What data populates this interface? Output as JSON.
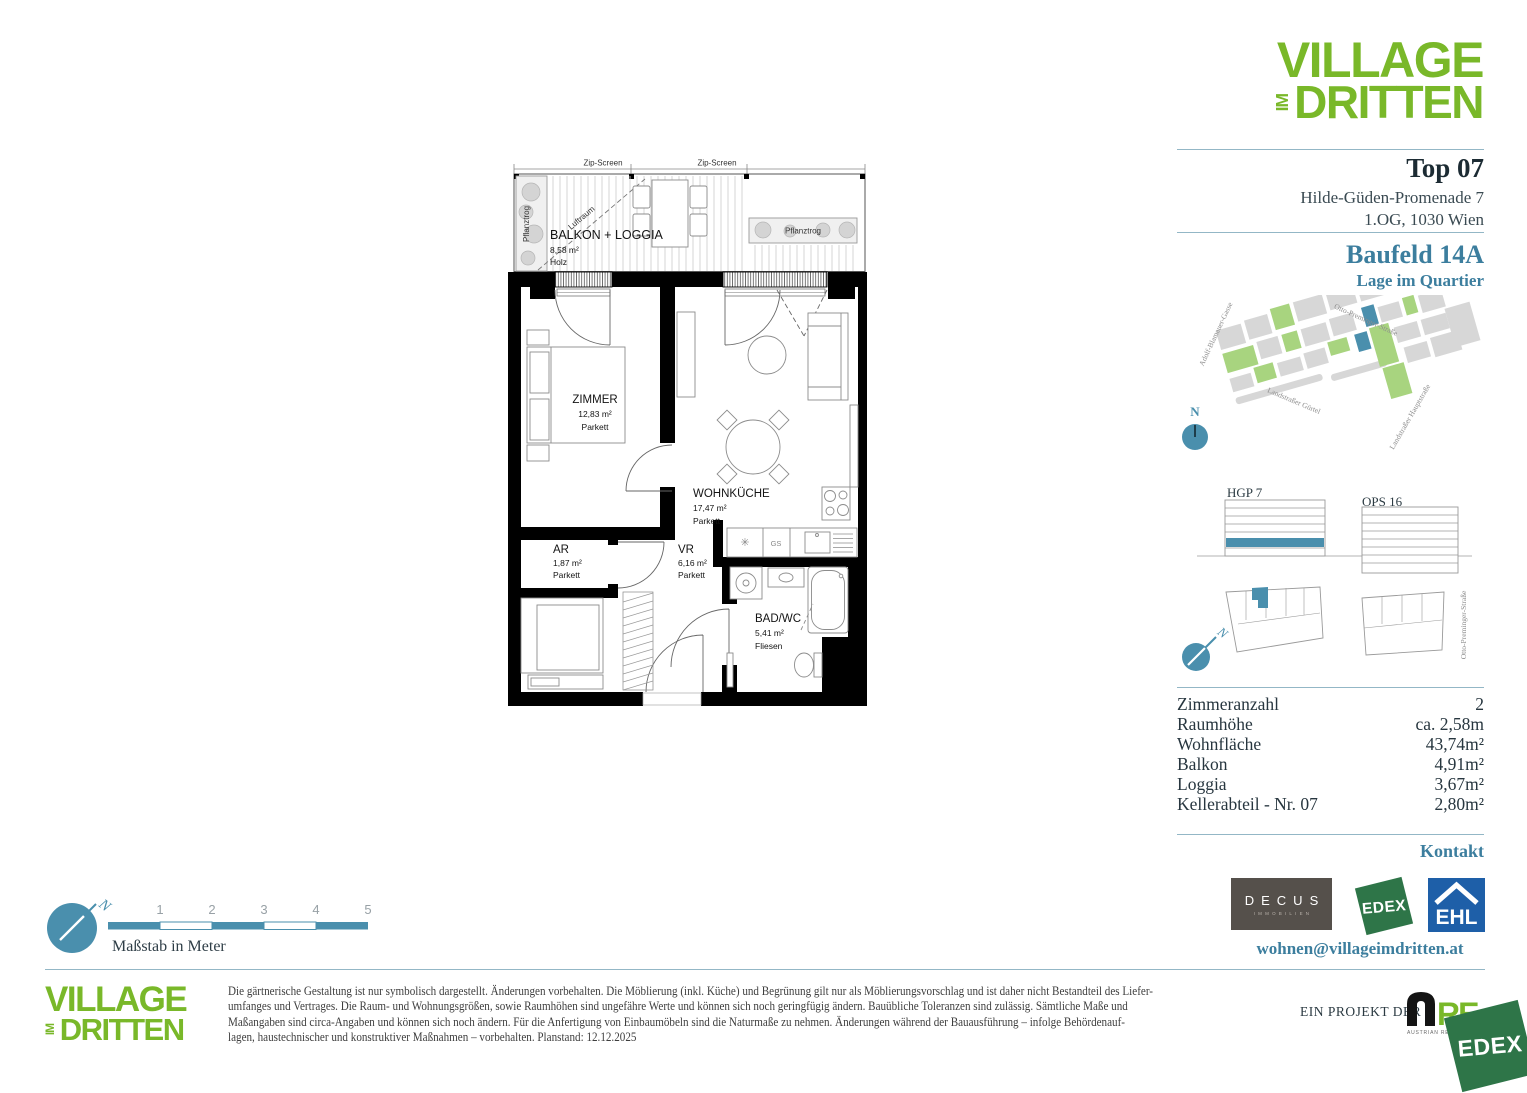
{
  "page": {
    "accent_blue": "#4a8fad",
    "brand_green": "#79b829"
  },
  "brand": {
    "line1": "VILLAGE",
    "im": "IM",
    "line2": "DRITTEN"
  },
  "header": {
    "unit": "Top 07",
    "address1": "Hilde-Güden-Promenade 7",
    "address2": "1.OG, 1030 Wien",
    "baufeld": "Baufeld 14A",
    "baufeld_sub": "Lage im Quartier"
  },
  "map": {
    "street_left": "Adolf-Blamauer-Gasse",
    "street_top": "Otto-Preminger-Straße",
    "street_bottom": "Landstraßer Gürtel",
    "street_right": "Landstraßer Hauptstraße",
    "north": "N"
  },
  "site": {
    "building_left": "HGP 7",
    "building_right": "OPS 16",
    "street_vertical": "Otto-Preminger-Straße",
    "north": "N"
  },
  "details": {
    "rows": [
      {
        "label": "Zimmeranzahl",
        "value": "2"
      },
      {
        "label": "Raumhöhe",
        "value": "ca. 2,58m"
      },
      {
        "label": "Wohnfläche",
        "value": "43,74m²"
      },
      {
        "label": "Balkon",
        "value": "4,91m²"
      },
      {
        "label": "Loggia",
        "value": "3,67m²"
      },
      {
        "label": "Kellerabteil - Nr. 07",
        "value": "2,80m²"
      }
    ]
  },
  "contact": {
    "heading": "Kontakt",
    "email": "wohnen@villageimdritten.at"
  },
  "logos": {
    "decus": "DECUS",
    "decus_sub": "IMMOBILIEN",
    "edex": "EDEX",
    "ehl": "EHL",
    "are_re": "RE",
    "are_sub": "AUSTRIAN REAL ESTATE"
  },
  "plan": {
    "zip_screen": "Zip-Screen",
    "pflanztrog": "Pflanztrog",
    "luftraum": "Luftraum",
    "gs": "GS",
    "balkon": {
      "name": "BALKON + LOGGIA",
      "area": "8,58 m²",
      "floor": "Holz"
    },
    "zimmer": {
      "name": "ZIMMER",
      "area": "12,83 m²",
      "floor": "Parkett"
    },
    "wohnkueche": {
      "name": "WOHNKÜCHE",
      "area": "17,47 m²",
      "floor": "Parkett"
    },
    "ar": {
      "name": "AR",
      "area": "1,87 m²",
      "floor": "Parkett"
    },
    "vr": {
      "name": "VR",
      "area": "6,16 m²",
      "floor": "Parkett"
    },
    "bad": {
      "name": "BAD/WC",
      "area": "5,41 m²",
      "floor": "Fliesen"
    }
  },
  "scale": {
    "caption": "Maßstab in Meter",
    "ticks": [
      "1",
      "2",
      "3",
      "4",
      "5"
    ]
  },
  "footer": {
    "project": "EIN PROJEKT DER",
    "disclaimer": [
      "Die gärtnerische Gestaltung ist nur symbolisch dargestellt. Änderungen vorbehalten. Die Möblierung (inkl. Küche) und Begrünung gilt nur als Möblierungsvorschlag und ist daher nicht Bestandteil des Liefer-",
      "umfanges und Vertrages. Die Raum- und Wohnungsgrößen, sowie Raumhöhen sind ungefähre Werte und können sich noch geringfügig ändern. Bauübliche Toleranzen sind zulässig. Sämtliche Maße und",
      "Maßangaben sind circa-Angaben und können sich noch ändern. Für die Anfertigung von Einbaumöbeln sind die Naturmaße zu nehmen. Änderungen während der Bauausführung – infolge Behördenauf-",
      "lagen, haustechnischer und konstruktiver Maßnahmen – vorbehalten. Planstand: 12.12.2025"
    ]
  }
}
